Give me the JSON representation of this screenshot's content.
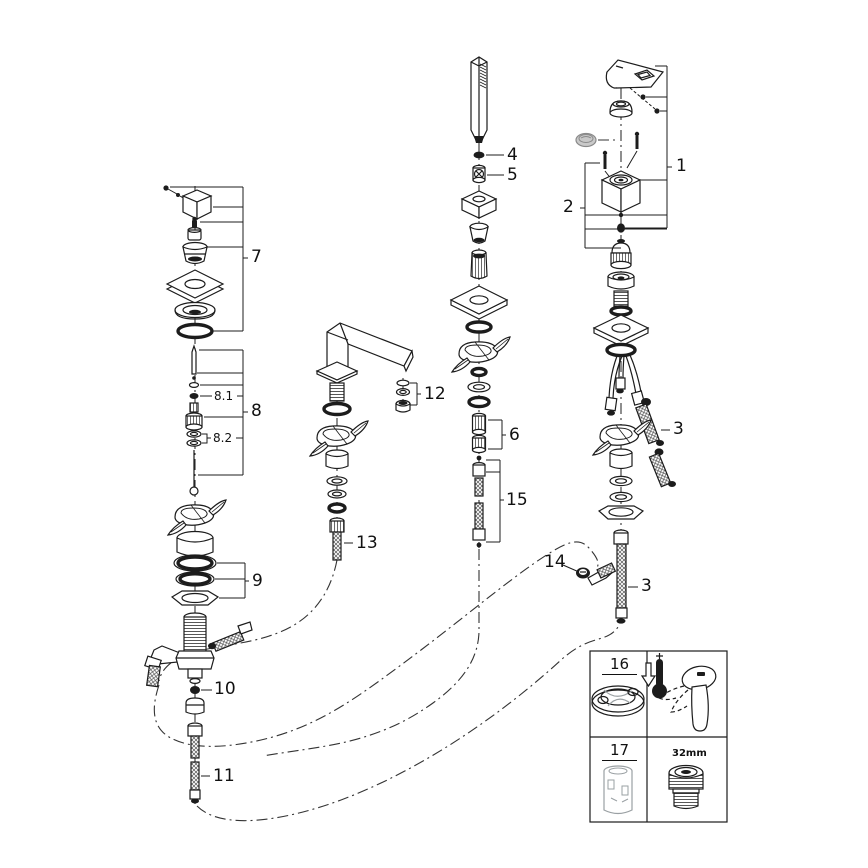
{
  "diagram": {
    "callouts": {
      "c1": "1",
      "c2": "2",
      "c3_upper": "3",
      "c3_lower": "3",
      "c4": "4",
      "c5": "5",
      "c6": "6",
      "c7": "7",
      "c8": "8",
      "c8_1": "8.1",
      "c8_2": "8.2",
      "c9": "9",
      "c10": "10",
      "c11": "11",
      "c12": "12",
      "c13": "13",
      "c14": "14",
      "c15": "15"
    },
    "legend": {
      "item16": "16",
      "item17": "17",
      "size_label": "32mm"
    },
    "colors": {
      "line": "#1c1c1c",
      "background": "#ffffff",
      "plug_gray": "#c9c9c9",
      "legend_part_gray": "#9aa0a3"
    }
  }
}
